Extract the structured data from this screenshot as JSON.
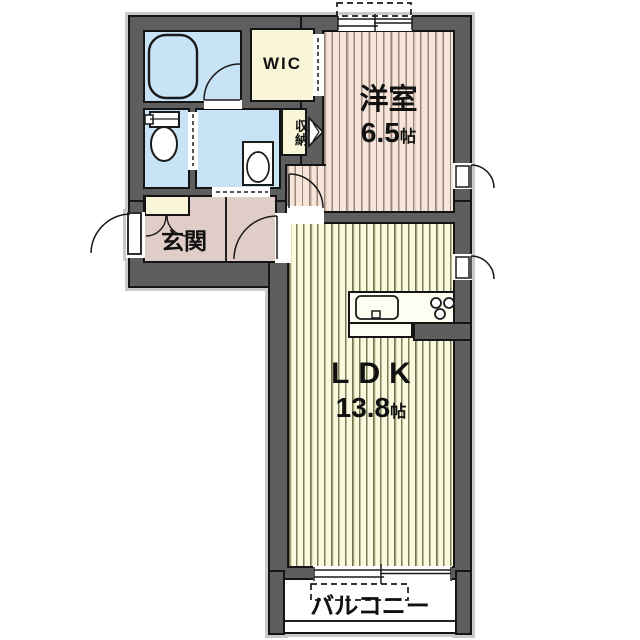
{
  "plan": {
    "type": "apartment-floorplan",
    "rooms": {
      "western_room": {
        "label": "洋室",
        "area_value": "6.5",
        "area_unit": "帖"
      },
      "ldk": {
        "label": "LDK",
        "area_value": "13.8",
        "area_unit": "帖"
      },
      "wic": {
        "label": "WIC"
      },
      "storage": {
        "label": "収納"
      },
      "entrance": {
        "label": "玄関"
      },
      "balcony": {
        "label": "バルコニー"
      },
      "bathroom": {
        "label": ""
      },
      "toilet": {
        "label": ""
      },
      "washroom": {
        "label": ""
      }
    },
    "fixtures": [
      "bathtub",
      "toilet-bowl",
      "washbasin",
      "kitchen-sink",
      "stove-burners",
      "shoe-cabinet",
      "ac-unit-outline-top",
      "ac-unit-outline-balcony"
    ],
    "colors": {
      "wall": "#5e5e5e",
      "outline": "#161616",
      "water_rooms": "#c8e2f6",
      "closets": "#f8f5d8",
      "hallway": "#e0cdc8",
      "western_room": "#f7e5da",
      "ldk": "#fafade",
      "balcony": "#ffffff",
      "shadow": "#c9c9c9"
    }
  }
}
